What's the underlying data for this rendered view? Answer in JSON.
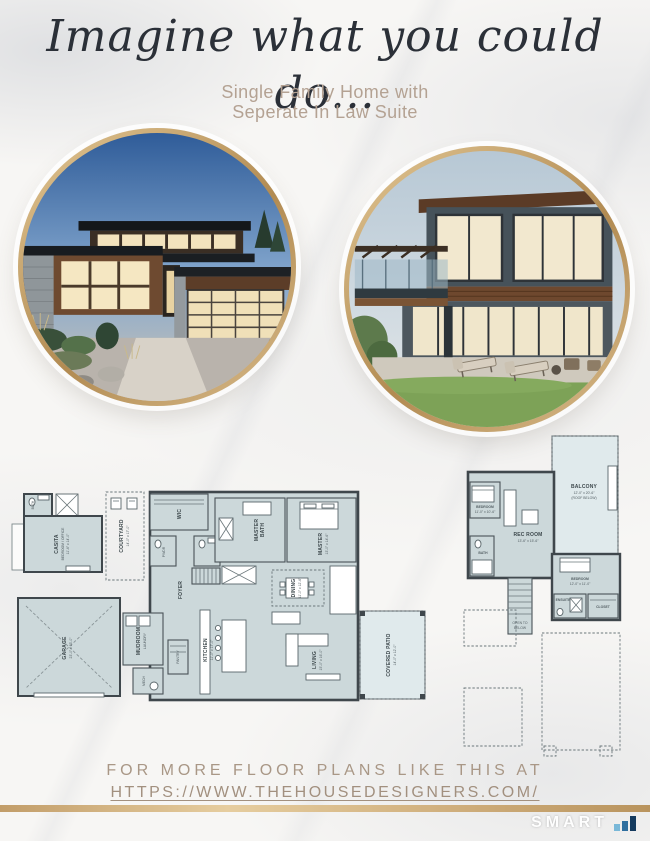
{
  "header": {
    "title": "Imagine what you could do...",
    "subtitle_line1": "Single Family Home with",
    "subtitle_line2": "Seperate In Law Suite"
  },
  "colors": {
    "gold": "#c5a571",
    "taupe": "#b4a293",
    "link": "#a2907f",
    "plan_room": "#ccd8da",
    "plan_wall": "#3f474c",
    "logo_bar_light": "#79b8d8",
    "logo_bar_mid": "#2f6f9f",
    "logo_bar_dark": "#143a5e"
  },
  "floorplans": {
    "main": {
      "casita": {
        "label": "CASITA",
        "sub": "BEDROOM / OFFICE",
        "dims": "11'-6\" x 14'-0\""
      },
      "bath": {
        "label": "BATH"
      },
      "courtyard": {
        "label": "COURTYARD",
        "dims": "14'-0\" x 17'-0\""
      },
      "wic": {
        "label": "WIC"
      },
      "pwdr": {
        "label": "PWDR"
      },
      "foyer": {
        "label": "FOYER"
      },
      "masterbath": {
        "label": "MASTER",
        "label2": "BATH"
      },
      "master": {
        "label": "MASTER",
        "dims": "13'-0\" x 14'-6\""
      },
      "dining": {
        "label": "DINING",
        "dims": "11'-0\" x 12'-6\""
      },
      "kitchen": {
        "label": "KITCHEN",
        "dims": "11'-0\" x 17'-0\""
      },
      "living": {
        "label": "LIVING",
        "dims": "15'-0\" x 16'-0\""
      },
      "patio": {
        "label": "COVERED PATIO",
        "dims": "14'-0\" x 12'-0\""
      },
      "garage": {
        "label": "GARAGE",
        "dims": "23'-0\" x 23'-0\""
      },
      "mudroom": {
        "label": "MUDROOM",
        "label2": "LAUNDRY"
      },
      "mech": {
        "label": "MECH"
      },
      "pantry": {
        "label": "PANTRY"
      }
    },
    "upper": {
      "bedroom1": {
        "label": "BEDROOM",
        "dims": "11'-0\" x 10'-6\""
      },
      "recroom": {
        "label": "REC ROOM",
        "dims": "13'-6\" x 15'-6\""
      },
      "balcony": {
        "label": "BALCONY",
        "dims": "12'-0\" x 20'-6\"",
        "note": "(ROOF BELOW)"
      },
      "bath": {
        "label": "BATH"
      },
      "bedroom2": {
        "label": "BEDROOM",
        "dims": "12'-0\" x 11'-0\""
      },
      "ensuite": {
        "label": "ENSUITE"
      },
      "closet": {
        "label": "CLOSET"
      },
      "stairs": {
        "label": "OPEN TO",
        "label2": "BELOW"
      }
    }
  },
  "footer": {
    "line1": "FOR MORE FLOOR PLANS LIKE THIS AT",
    "url": "HTTPS://WWW.THEHOUSEDESIGNERS.COM/"
  },
  "logo": {
    "text": "SMART"
  }
}
